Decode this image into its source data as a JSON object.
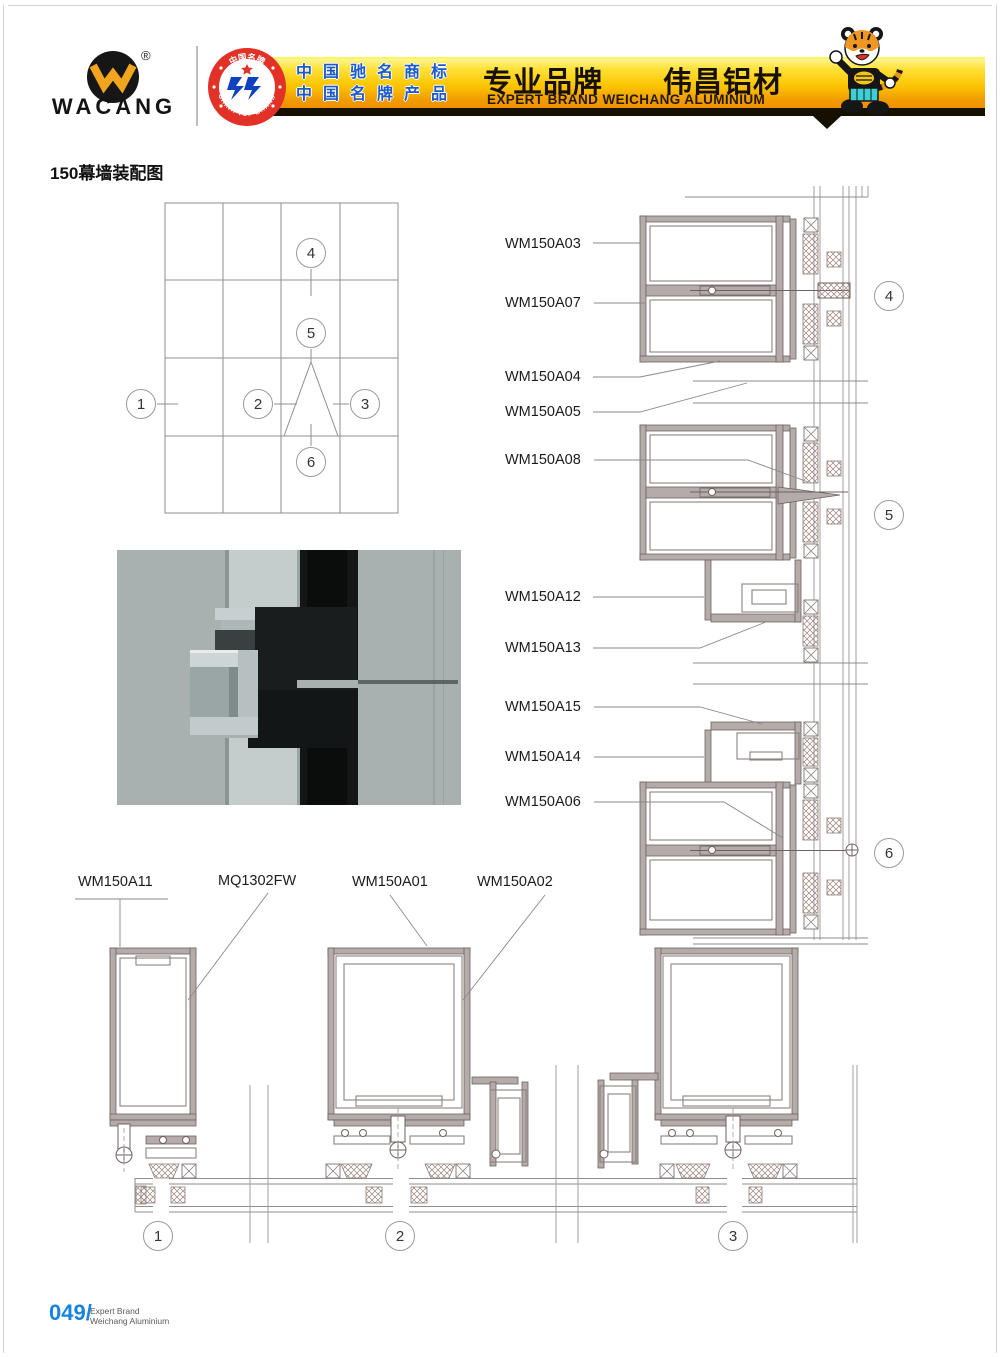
{
  "header": {
    "brand": "WACANG",
    "registered_mark": "®",
    "badge": {
      "top_text": "中国名牌",
      "bottom_text": "CHINA TOP BRAND"
    },
    "banner": {
      "claim_line1": "中国驰名商标",
      "claim_line2": "中国名牌产品",
      "title_cn": "专业品牌　　伟昌铝材",
      "subtitle_en": "EXPERT BRAND WEICHANG ALUMINIUM"
    }
  },
  "page_title": "150幕墙装配图",
  "labels": {
    "right": [
      "WM150A03",
      "WM150A07",
      "WM150A04",
      "WM150A05",
      "WM150A08",
      "WM150A12",
      "WM150A13",
      "WM150A15",
      "WM150A14",
      "WM150A06"
    ],
    "bottom": [
      "WM150A11",
      "MQ1302FW",
      "WM150A01",
      "WM150A02"
    ]
  },
  "callouts": {
    "grid": [
      "1",
      "2",
      "3",
      "4",
      "5",
      "6"
    ],
    "right_details": [
      "4",
      "5",
      "6"
    ],
    "bottom_details": [
      "1",
      "2",
      "3"
    ]
  },
  "footer": {
    "page_number": "049/",
    "line1": "Expert Brand",
    "line2": "Weichang Aluminium"
  },
  "colors": {
    "banner_yellow": "#fbc501",
    "banner_orange": "#ee8e00",
    "claim_blue": "#1b5ac8",
    "badge_red": "#e23127",
    "emblem_blue": "#1040c0",
    "footer_blue": "#1583e0",
    "profile_gray": "#b3acaa",
    "profile_line": "#6e6260"
  }
}
